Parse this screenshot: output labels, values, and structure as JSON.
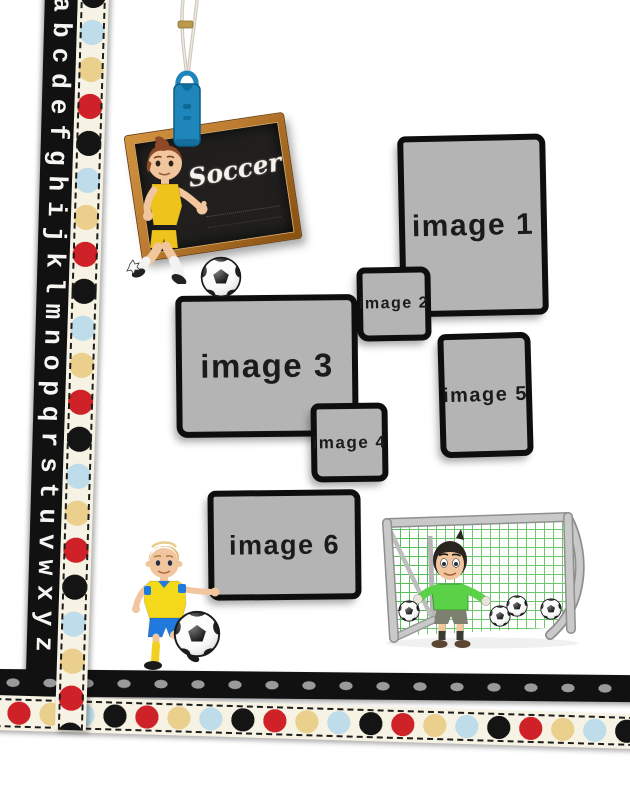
{
  "page": {
    "type": "soccer scrapbook template page"
  },
  "alphabet_ribbon": {
    "letters": "abcdefghijklmnopqrstuvwxyz"
  },
  "sign": {
    "title": "Soccer"
  },
  "placeholders": [
    {
      "label": "image 1"
    },
    {
      "label": "image 2"
    },
    {
      "label": "image 3"
    },
    {
      "label": "image 4"
    },
    {
      "label": "image 5"
    },
    {
      "label": "image 6"
    }
  ],
  "illustrations": {
    "sign_player": "girl-soccer-player-icon",
    "juggling_player": "boy-soccer-player-icon",
    "goalkeeper": "goalkeeper-with-goal-icon",
    "soccer_ball": "soccer-ball-icon",
    "hanging_cord": "hanging-cord-with-clip-icon"
  },
  "colors": {
    "page_bg": "#ffffff",
    "ribbon_black": "#111111",
    "ribbon_cream": "#f7f3e4",
    "alphabet_white": "#f5f5f2",
    "dot_red": "#cf2128",
    "dot_tan": "#eacf8d",
    "dot_blue": "#bedce9",
    "dot_dark": "#141414",
    "gray_dot": "#9a9a9a",
    "placeholder_fill": "#b4b4b4",
    "placeholder_border": "#0e0e0e",
    "placeholder_text": "#1b1b1b",
    "board_surface": "#201f1d",
    "frame_wood": "#bd7c31",
    "frame_wood_dark": "#86500f",
    "chalk": "#f4f2ea",
    "clip_blue": "#1e86ba",
    "string_gray": "#cfc9bd",
    "goal_gray": "#c9c9c9",
    "net_green": "#53bd53",
    "keeper_green": "#5ad146",
    "skin": "#f1c69e",
    "girl_kit": "#eec31c",
    "boy_shirt": "#f4d91a",
    "boy_shorts": "#2079dd",
    "hair_auburn": "#8e4a28",
    "hair_blonde": "#dcb76b",
    "hair_dark": "#2b2522",
    "ball_white": "#fbfbfb",
    "ball_black": "#161616"
  }
}
